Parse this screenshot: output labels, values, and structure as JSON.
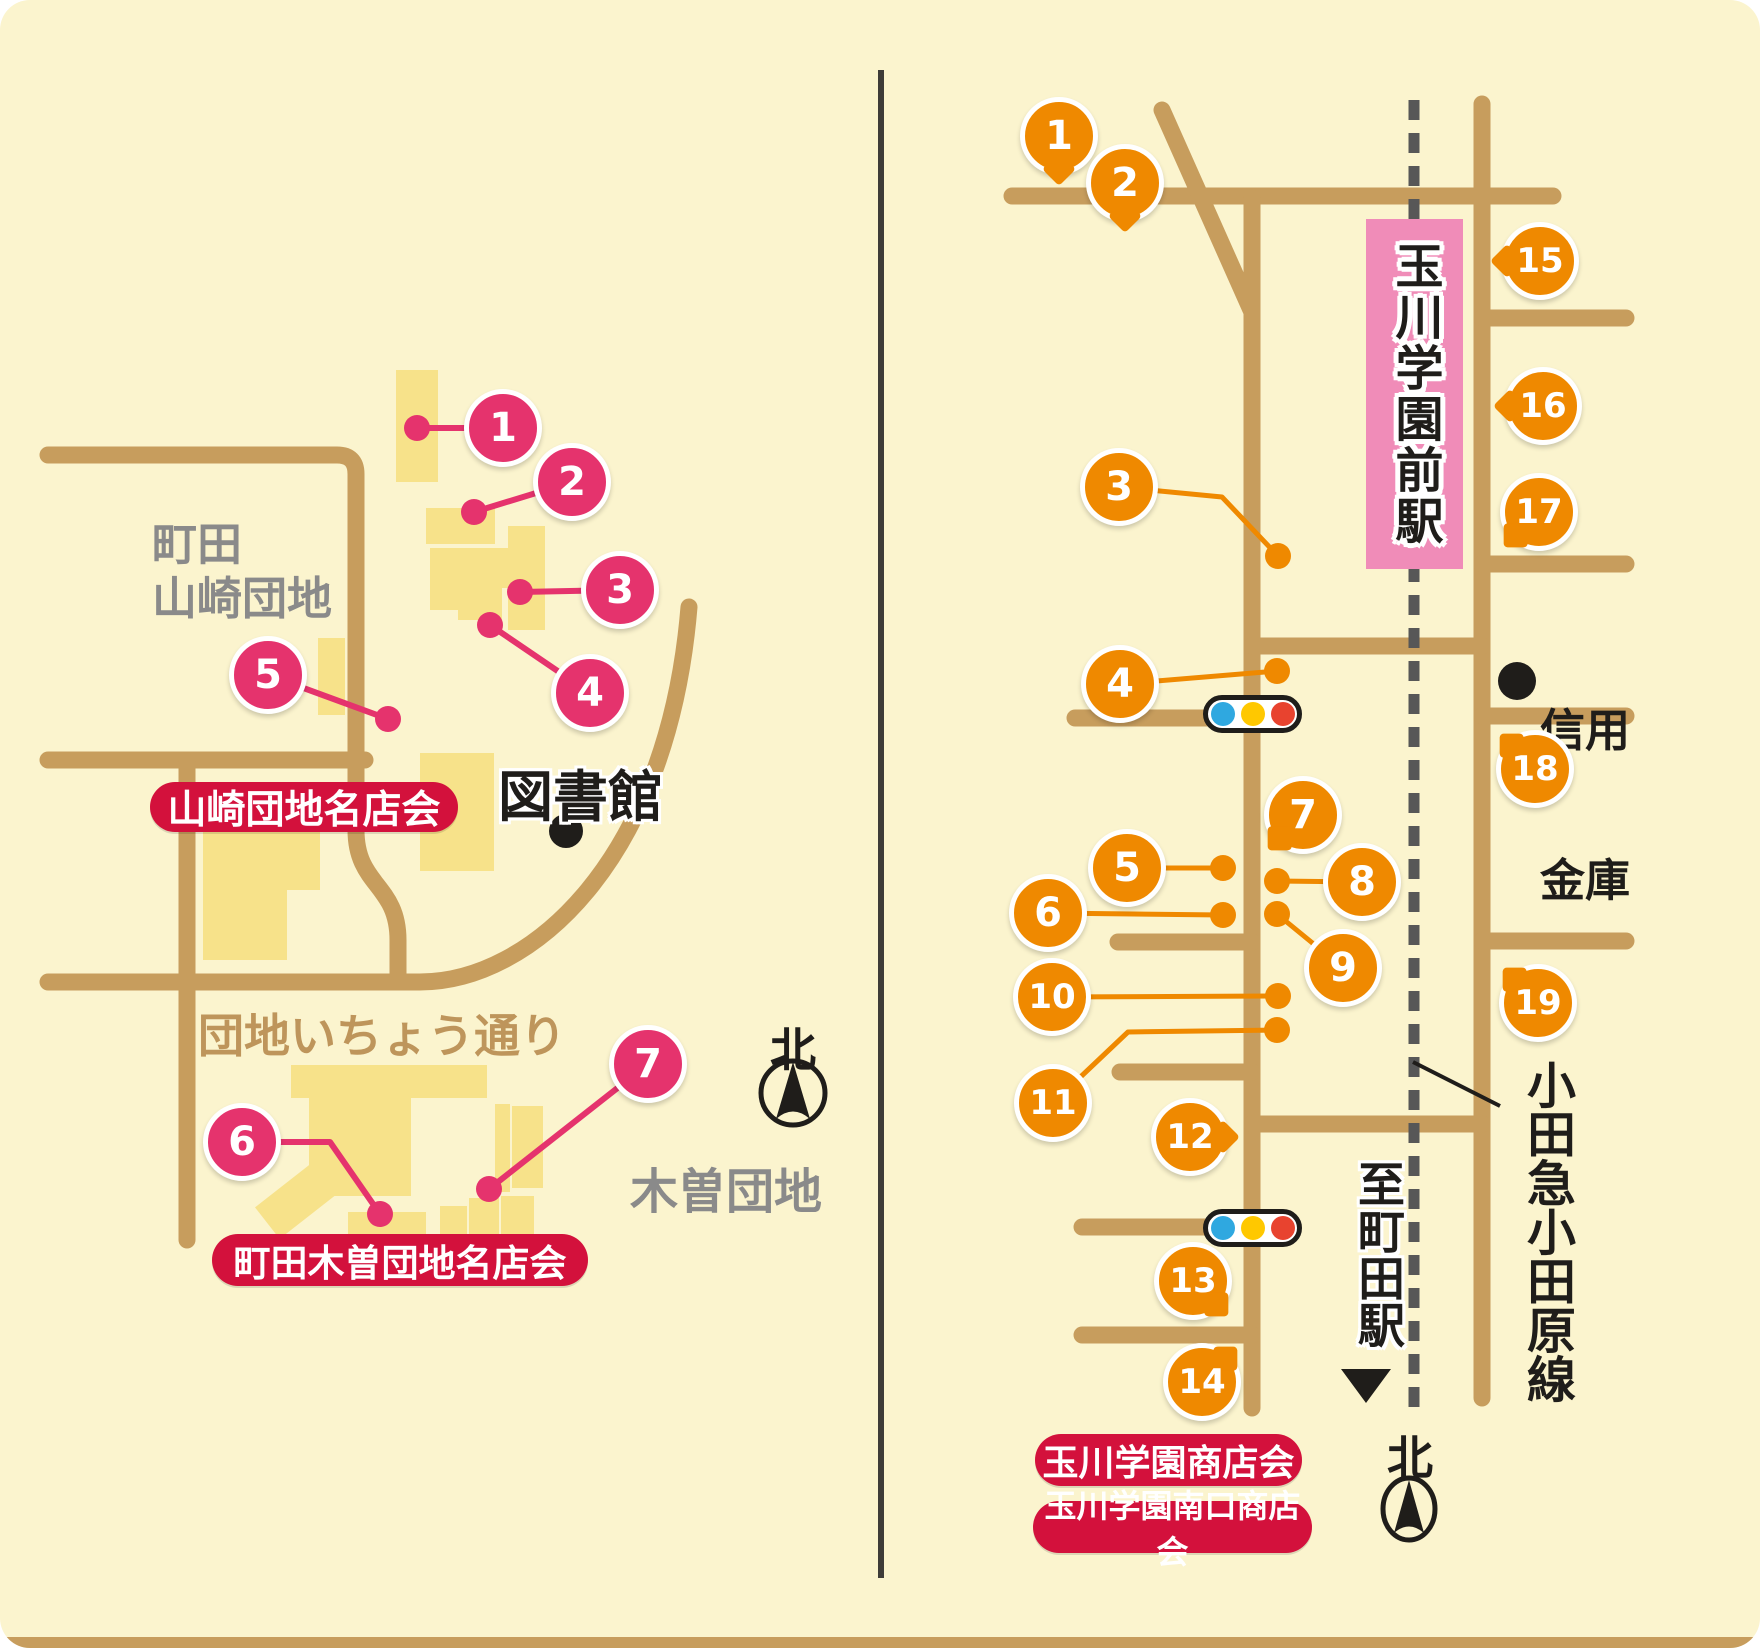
{
  "colors": {
    "cream": "#FBF4CE",
    "road": "#C79D5D",
    "building": "#F7E28A",
    "pink": "#E5336D",
    "orange": "#EF8900",
    "badge_red": "#D3113C",
    "station_pink": "#F08CB8",
    "rail_gray": "#575757",
    "gray_text": "#8A8A8A",
    "road_label": "#BE955B",
    "ink": "#1F1D1A",
    "signal_blue": "#2FA8E0",
    "signal_yellow": "#FFC800",
    "signal_red": "#E8432F"
  },
  "left_map": {
    "district_line1": "町田",
    "district_line2": "山崎団地",
    "library_label": "図書館",
    "street_label": "団地いちょう通り",
    "kiso_district_label": "木曽団地",
    "yamazaki_badge": "山崎団地名店会",
    "kiso_badge": "町田木曽団地名店会",
    "compass_label": "北",
    "markers": [
      {
        "n": "1",
        "type": "circle",
        "x": 503,
        "y": 428,
        "leader": [
          [
            503,
            428
          ],
          [
            417,
            428
          ]
        ],
        "dot": [
          417,
          428
        ]
      },
      {
        "n": "2",
        "type": "circle",
        "x": 572,
        "y": 482,
        "leader": [
          [
            572,
            482
          ],
          [
            474,
            512
          ]
        ],
        "dot": [
          474,
          512
        ]
      },
      {
        "n": "3",
        "type": "circle",
        "x": 620,
        "y": 590,
        "leader": [
          [
            620,
            590
          ],
          [
            520,
            592
          ]
        ],
        "dot": [
          520,
          592
        ]
      },
      {
        "n": "4",
        "type": "circle",
        "x": 590,
        "y": 693,
        "leader": [
          [
            590,
            693
          ],
          [
            490,
            625
          ]
        ],
        "dot": [
          490,
          625
        ]
      },
      {
        "n": "5",
        "type": "circle",
        "x": 268,
        "y": 675,
        "leader": [
          [
            268,
            675
          ],
          [
            388,
            719
          ]
        ],
        "dot": [
          388,
          719
        ]
      },
      {
        "n": "6",
        "type": "circle",
        "x": 242,
        "y": 1142,
        "leader": [
          [
            242,
            1142
          ],
          [
            330,
            1142
          ],
          [
            380,
            1214
          ]
        ],
        "dot": [
          380,
          1214
        ]
      },
      {
        "n": "7",
        "type": "circle",
        "x": 648,
        "y": 1064,
        "leader": [
          [
            648,
            1064
          ],
          [
            489,
            1189
          ]
        ],
        "dot": [
          489,
          1189
        ]
      }
    ]
  },
  "right_map": {
    "station_label": "玉川学園前駅",
    "bank_line1": "信用",
    "bank_line2": "金庫",
    "railway_label": "小田急小田原線",
    "to_machida_label": "至町田駅",
    "shop_badge_1": "玉川学園商店会",
    "shop_badge_2": "玉川学園南口商店会",
    "compass_label": "北",
    "markers": [
      {
        "n": "1",
        "type": "balloon",
        "x": 1059,
        "y": 136,
        "tail": 90
      },
      {
        "n": "2",
        "type": "balloon",
        "x": 1125,
        "y": 183,
        "tail": 90
      },
      {
        "n": "3",
        "type": "circle",
        "x": 1119,
        "y": 487,
        "leader": [
          [
            1119,
            487
          ],
          [
            1222,
            497
          ],
          [
            1278,
            556
          ]
        ],
        "dot": [
          1278,
          556
        ]
      },
      {
        "n": "4",
        "type": "circle",
        "x": 1120,
        "y": 684,
        "leader": [
          [
            1120,
            684
          ],
          [
            1277,
            671
          ]
        ],
        "dot": [
          1277,
          671
        ]
      },
      {
        "n": "5",
        "type": "circle",
        "x": 1127,
        "y": 868,
        "leader": [
          [
            1127,
            868
          ],
          [
            1223,
            868
          ]
        ],
        "dot": [
          1223,
          868
        ]
      },
      {
        "n": "6",
        "type": "circle",
        "x": 1048,
        "y": 913,
        "leader": [
          [
            1048,
            913
          ],
          [
            1223,
            915
          ]
        ],
        "dot": [
          1223,
          915
        ]
      },
      {
        "n": "7",
        "type": "balloon",
        "x": 1303,
        "y": 815,
        "tail": 135
      },
      {
        "n": "8",
        "type": "circle",
        "x": 1362,
        "y": 882,
        "leader": [
          [
            1362,
            882
          ],
          [
            1277,
            881
          ]
        ],
        "dot": [
          1277,
          881
        ]
      },
      {
        "n": "9",
        "type": "circle",
        "x": 1343,
        "y": 968,
        "leader": [
          [
            1343,
            968
          ],
          [
            1277,
            914
          ]
        ],
        "dot": [
          1277,
          914
        ]
      },
      {
        "n": "10",
        "type": "circle",
        "x": 1052,
        "y": 997,
        "leader": [
          [
            1052,
            997
          ],
          [
            1278,
            996
          ]
        ],
        "dot": [
          1278,
          996
        ]
      },
      {
        "n": "11",
        "type": "circle",
        "x": 1053,
        "y": 1103,
        "leader": [
          [
            1053,
            1103
          ],
          [
            1128,
            1032
          ],
          [
            1277,
            1030
          ]
        ],
        "dot": [
          1277,
          1030
        ]
      },
      {
        "n": "12",
        "type": "balloon",
        "x": 1190,
        "y": 1137,
        "tail": 0
      },
      {
        "n": "13",
        "type": "balloon",
        "x": 1193,
        "y": 1281,
        "tail": 45
      },
      {
        "n": "14",
        "type": "balloon",
        "x": 1202,
        "y": 1382,
        "tail": -45
      },
      {
        "n": "15",
        "type": "balloon",
        "x": 1540,
        "y": 261,
        "tail": 180
      },
      {
        "n": "16",
        "type": "balloon",
        "x": 1543,
        "y": 406,
        "tail": 180
      },
      {
        "n": "17",
        "type": "balloon",
        "x": 1539,
        "y": 512,
        "tail": 135
      },
      {
        "n": "18",
        "type": "balloon",
        "x": 1535,
        "y": 769,
        "tail": 225
      },
      {
        "n": "19",
        "type": "balloon",
        "x": 1538,
        "y": 1003,
        "tail": 225
      }
    ]
  }
}
